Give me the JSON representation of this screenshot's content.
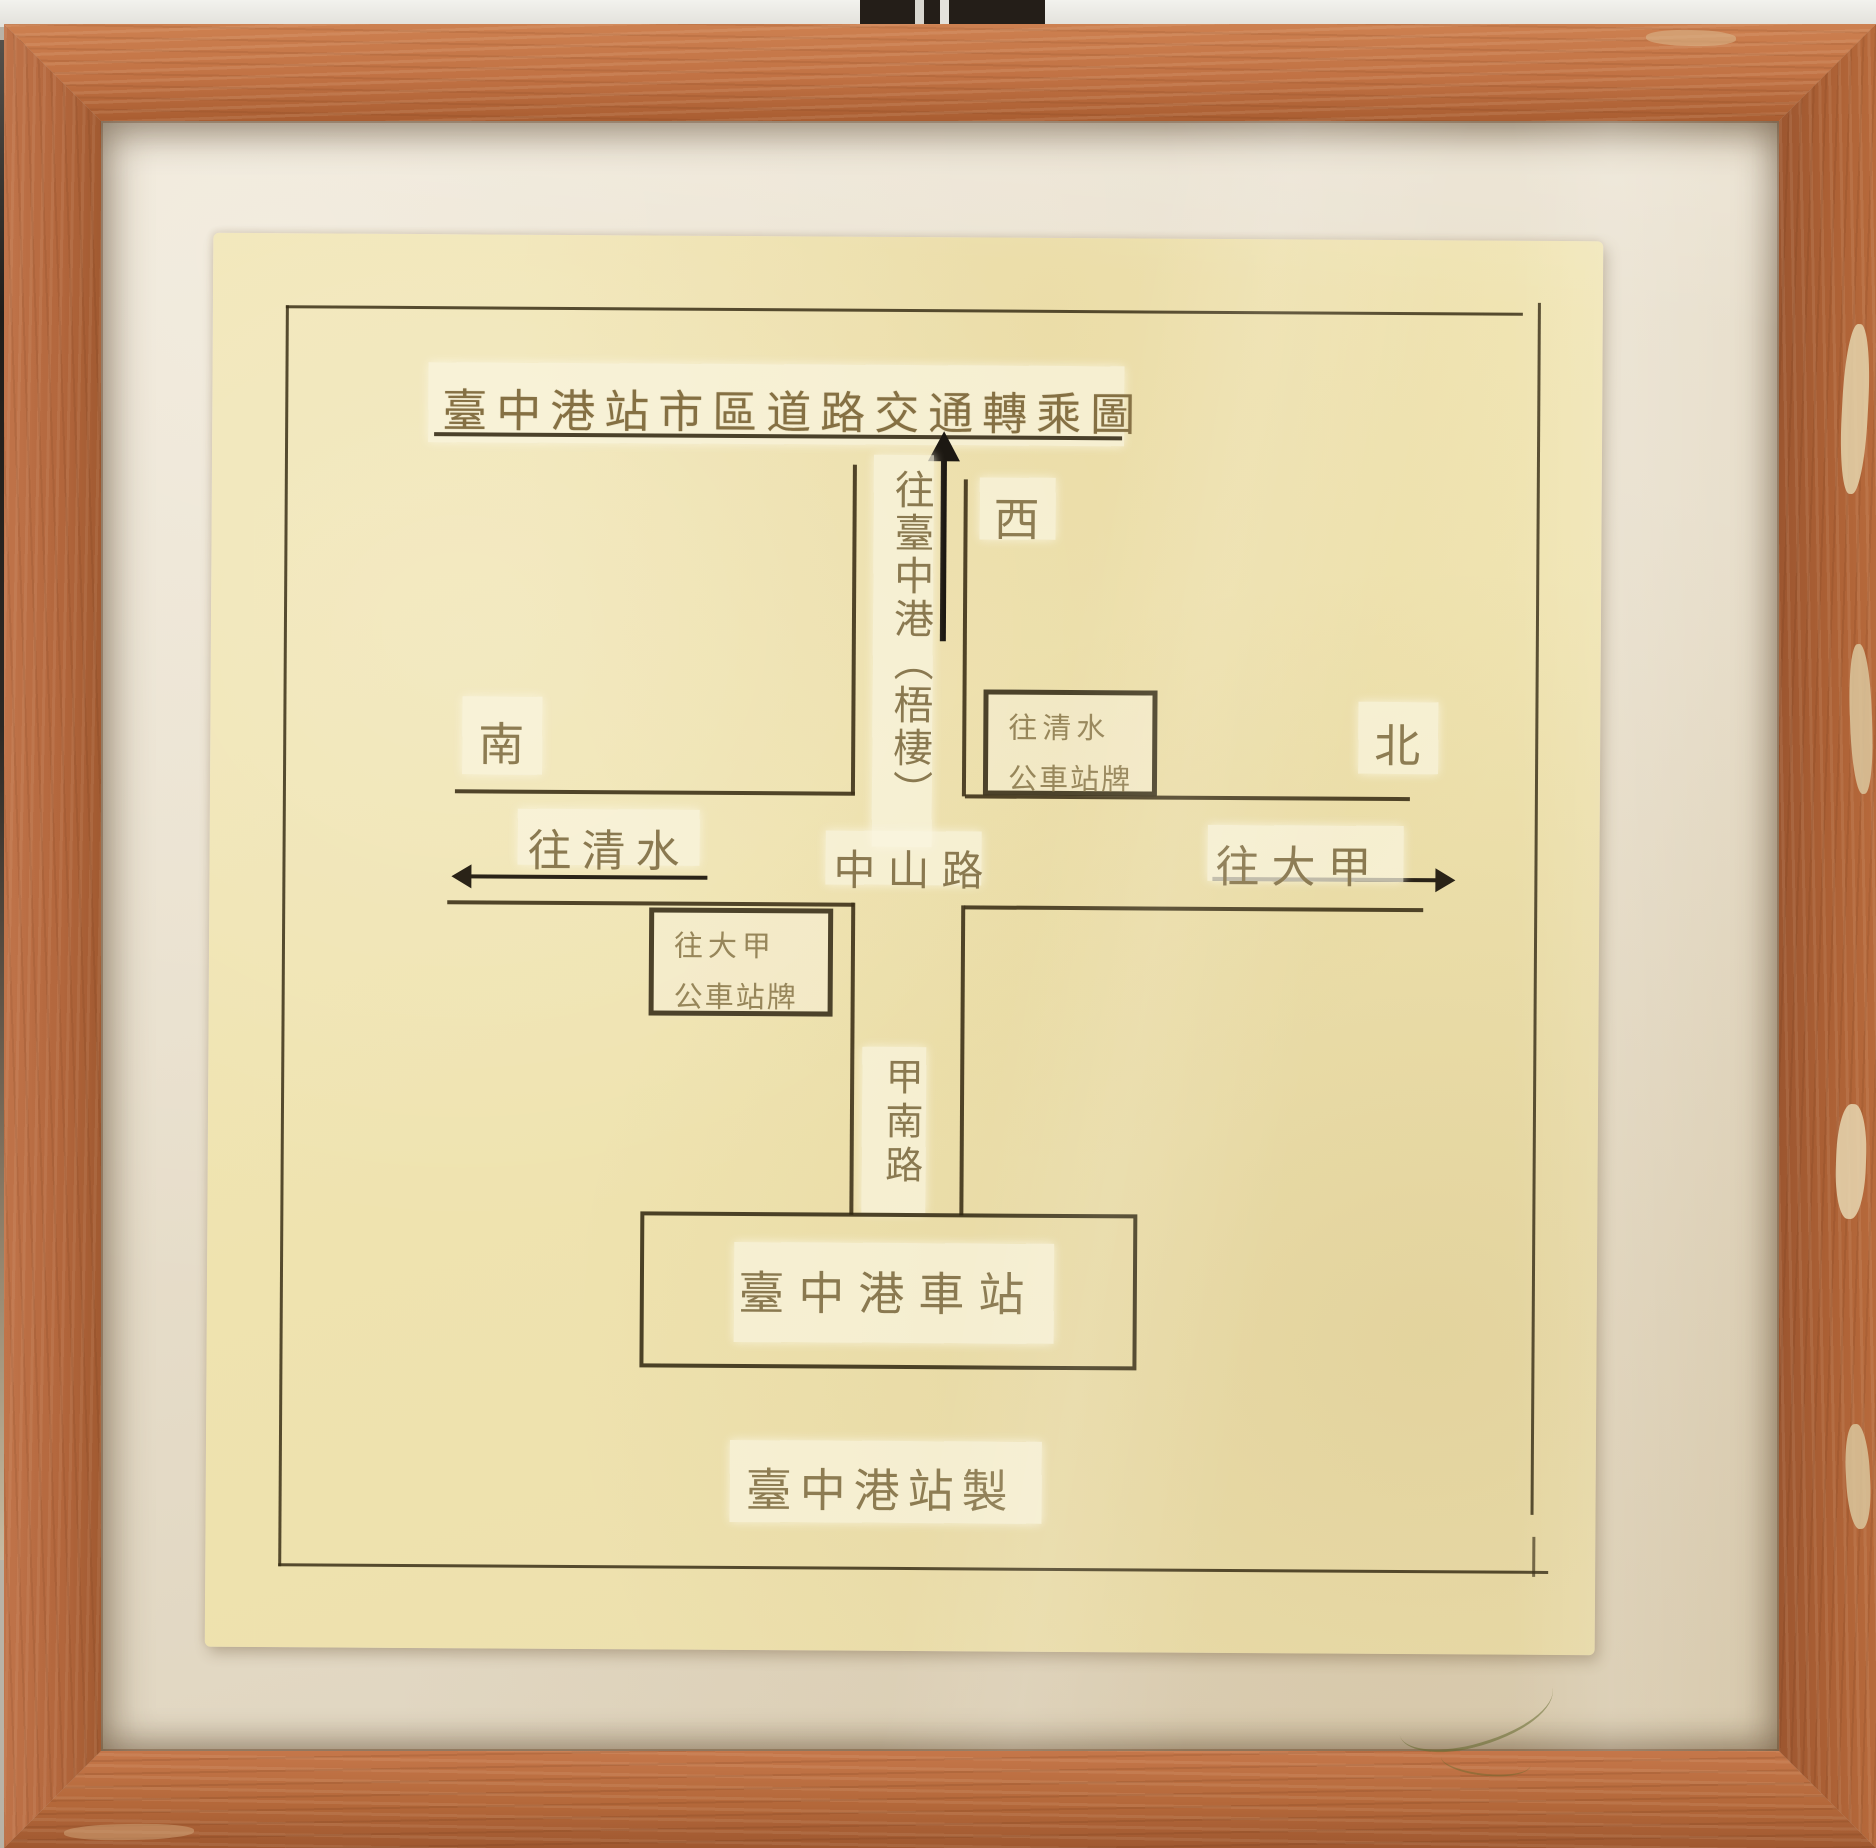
{
  "title": {
    "text": "臺中港站市區道路交通轉乘圖"
  },
  "compass": {
    "west": "西",
    "south": "南",
    "north": "北"
  },
  "roads": {
    "vertical_up_label": "往臺中港（梧棲）",
    "zhongshan_road": "中山路",
    "jianan_road": "甲南路",
    "to_qingshui": "往清水",
    "to_dajia": "往大甲"
  },
  "bus_stops": {
    "qingshui": {
      "line1": "往清水",
      "line2": "公車站牌"
    },
    "dajia": {
      "line1": "往大甲",
      "line2": "公車站牌"
    }
  },
  "station": {
    "label": "臺中港車站"
  },
  "credit": {
    "text": "臺中港站製"
  },
  "colors": {
    "frame_wood": "#bb6f3f",
    "matte": "#e8dfcc",
    "paper": "#efe3b2",
    "ink": "#3e3318",
    "arrow_black": "#1c1812",
    "faded_ink": "#8a7950",
    "box_border": "#352a10"
  }
}
